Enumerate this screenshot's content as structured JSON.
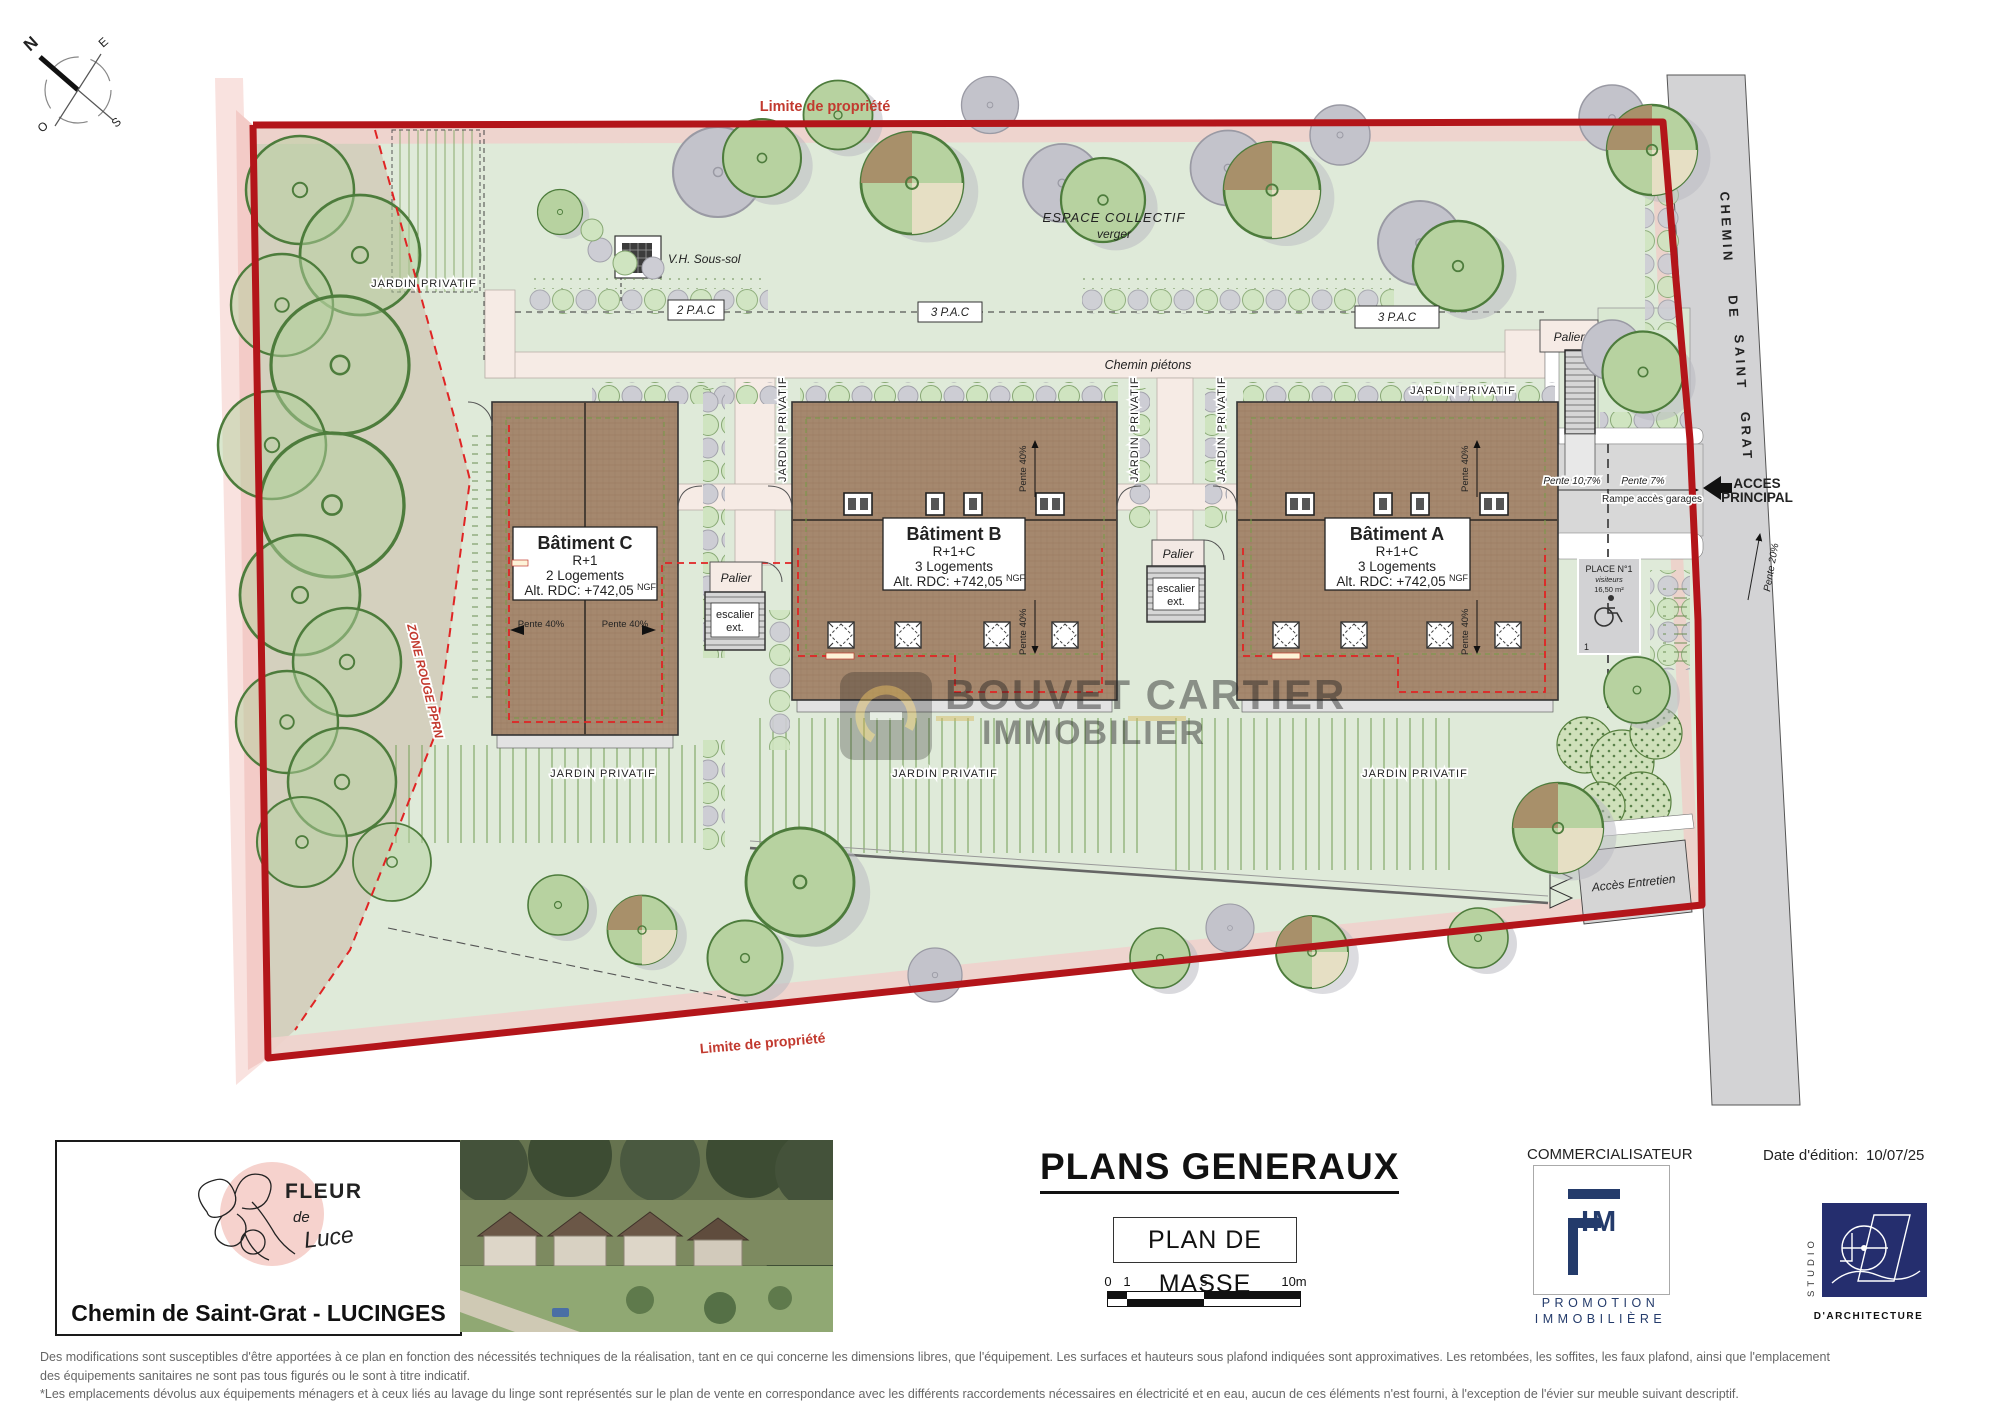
{
  "plan": {
    "limite_propriete": "Limite de propriété",
    "espace_collectif": "ESPACE COLLECTIF",
    "verger": "verger",
    "vh_sous_sol": "V.H. Sous-sol",
    "pac_2": "2 P.A.C",
    "pac_3": "3 P.A.C",
    "chemin_pietons": "Chemin piétons",
    "jardin_privatif": "JARDIN PRIVATIF",
    "palier": "Palier",
    "escalier_l1": "escalier",
    "escalier_l2": "ext.",
    "zone_rouge_pprn": "ZONE ROUGE PPRN",
    "acces_l1": "ACCES",
    "acces_l2": "PRINCIPAL",
    "acces_entretien": "Accès Entretien",
    "rampe_acces_garages": "Rampe accès garages",
    "pente_40": "Pente 40%",
    "pente_10_7": "Pente 10,7%",
    "pente_7": "Pente 7%",
    "pente_20": "Pente 20%",
    "place_n1": "PLACE N°1",
    "visiteurs": "visiteurs",
    "place_surface": "16,50 m²",
    "place_num": "1",
    "road": {
      "w1": "CHEMIN",
      "w2": "DE",
      "w3": "SAINT",
      "w4": "GRAT"
    },
    "compass": {
      "n": "N",
      "e": "E",
      "s": "S",
      "o": "O"
    },
    "buildings": {
      "c": {
        "name": "Bâtiment C",
        "floors": "R+1",
        "units": "2 Logements",
        "alt": "Alt. RDC: +742,05",
        "alt_sup": "NGF"
      },
      "b": {
        "name": "Bâtiment B",
        "floors": "R+1+C",
        "units": "3 Logements",
        "alt": "Alt. RDC: +742,05",
        "alt_sup": "NGF"
      },
      "a": {
        "name": "Bâtiment A",
        "floors": "R+1+C",
        "units": "3 Logements",
        "alt": "Alt. RDC: +742,05",
        "alt_sup": "NGF"
      }
    },
    "watermark": {
      "l1": "BOUVET CARTIER",
      "l2": "IMMOBILIER"
    }
  },
  "titleblock": {
    "logo": {
      "fleur": "FLEUR",
      "de": "de",
      "luce": "Luce"
    },
    "address": "Chemin de Saint-Grat - LUCINGES",
    "main_title": "PLANS GENERAUX",
    "subtitle": "PLAN DE MASSE",
    "scale": {
      "t0": "0",
      "t1": "1",
      "t5": "5",
      "t10": "10m"
    },
    "commercialisateur": "COMMERCIALISATEUR",
    "fim": {
      "glyph_letters": "IM",
      "promotion": "PROMOTION",
      "immobiliere": "IMMOBILIÈRE"
    },
    "date_label": "Date d'édition:",
    "date_value": "10/07/25",
    "studio_vertical": "STUDIO",
    "studio_bottom": "D'ARCHITECTURE"
  },
  "disclaimer": {
    "line1": "Des modifications sont susceptibles d'être apportées à ce plan en fonction des nécessités techniques de la réalisation, tant en ce qui concerne les dimensions libres, que l'équipement. Les surfaces et hauteurs sous plafond indiquées sont approximatives. Les retombées, les soffites, les faux plafond, ainsi que l'emplacement",
    "line2": "des équipements sanitaires ne sont pas tous figurés ou le sont à titre indicatif.",
    "line3": "*Les emplacements dévolus aux équipements ménagers et à ceux liés au lavage du linge sont représentés sur le plan de vente en correspondance avec les différents raccordements nécessaires en électricité et en eau, aucun de ces éléments n'est fourni, à l'exception de l'évier sur meuble suivant descriptif."
  },
  "colors": {
    "boundary-red": "#b3151a",
    "dash-red": "#e02424",
    "site-green": "#dfead9",
    "building-brown": "#a5886e",
    "road-gray": "#d3d3d5",
    "path-pink": "#f6ebe5",
    "navy": "#243b6b",
    "logo-pink": "#f6d2cd",
    "logo-red": "#c0453c",
    "label-red": "#c23a2f"
  }
}
